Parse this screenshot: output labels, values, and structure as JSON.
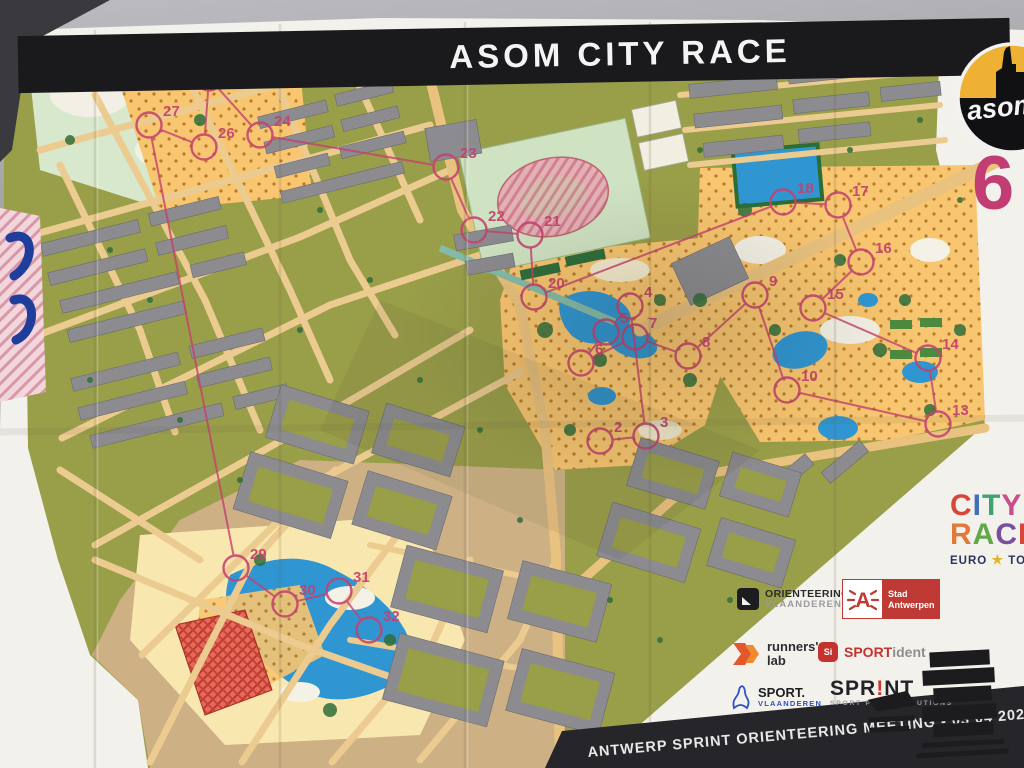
{
  "banner": {
    "title": "ASOM CITY RACE"
  },
  "asom_logo": {
    "text": "asom"
  },
  "course": {
    "number": "6",
    "color": "#c5416f",
    "controls": [
      {
        "n": "2",
        "x": 600,
        "y": 441
      },
      {
        "n": "3",
        "x": 646,
        "y": 436
      },
      {
        "n": "4",
        "x": 630,
        "y": 306
      },
      {
        "n": "5",
        "x": 606,
        "y": 332
      },
      {
        "n": "6",
        "x": 581,
        "y": 363
      },
      {
        "n": "7",
        "x": 635,
        "y": 337
      },
      {
        "n": "8",
        "x": 688,
        "y": 356
      },
      {
        "n": "9",
        "x": 755,
        "y": 295
      },
      {
        "n": "10",
        "x": 787,
        "y": 390
      },
      {
        "n": "13",
        "x": 938,
        "y": 424
      },
      {
        "n": "14",
        "x": 928,
        "y": 358
      },
      {
        "n": "15",
        "x": 813,
        "y": 308
      },
      {
        "n": "16",
        "x": 861,
        "y": 262
      },
      {
        "n": "17",
        "x": 838,
        "y": 205
      },
      {
        "n": "18",
        "x": 783,
        "y": 202
      },
      {
        "n": "20",
        "x": 534,
        "y": 297
      },
      {
        "n": "21",
        "x": 530,
        "y": 235
      },
      {
        "n": "22",
        "x": 474,
        "y": 230
      },
      {
        "n": "23",
        "x": 446,
        "y": 167
      },
      {
        "n": "24",
        "x": 260,
        "y": 135
      },
      {
        "n": "25",
        "x": 209,
        "y": 78
      },
      {
        "n": "26",
        "x": 204,
        "y": 147
      },
      {
        "n": "27",
        "x": 149,
        "y": 125
      },
      {
        "n": "29",
        "x": 236,
        "y": 568
      },
      {
        "n": "30",
        "x": 285,
        "y": 604
      },
      {
        "n": "31",
        "x": 339,
        "y": 591
      },
      {
        "n": "32",
        "x": 369,
        "y": 630
      }
    ]
  },
  "city_race_logo": {
    "line1": [
      [
        "C",
        "#d9453b"
      ],
      [
        "I",
        "#3f6fb5"
      ],
      [
        "T",
        "#3fa273"
      ],
      [
        "Y",
        "#c94d8c"
      ]
    ],
    "line2": [
      [
        "R",
        "#e0793a"
      ],
      [
        "A",
        "#62a84b"
      ],
      [
        "C",
        "#7a4fa0"
      ],
      [
        "E",
        "#d9453b"
      ]
    ],
    "euro": "EURO",
    "star": "★",
    "tour": "TOUR"
  },
  "sponsors": {
    "ov": {
      "line1": "ORIENTEERING",
      "line2": "VLAANDEREN"
    },
    "antwerp": {
      "letter": "A",
      "line1": "Stad",
      "line2": "Antwerpen"
    },
    "runnerslab": {
      "line1": "runners'",
      "line2": "lab"
    },
    "sportident": {
      "icon": "Si",
      "part1": "SPORT",
      "part2": "ident"
    },
    "sportvl": {
      "line1": "SPORT.",
      "line2": "VLAANDEREN"
    },
    "sprint": {
      "line1a": "SPR",
      "line1b": "!",
      "line1c": "NT",
      "line2": "SPORT PRINT SOLUTIONS"
    }
  },
  "footer": {
    "line1": "ANTWERP SPRINT ORIENTEERING MEETING - 03 04 2022"
  }
}
